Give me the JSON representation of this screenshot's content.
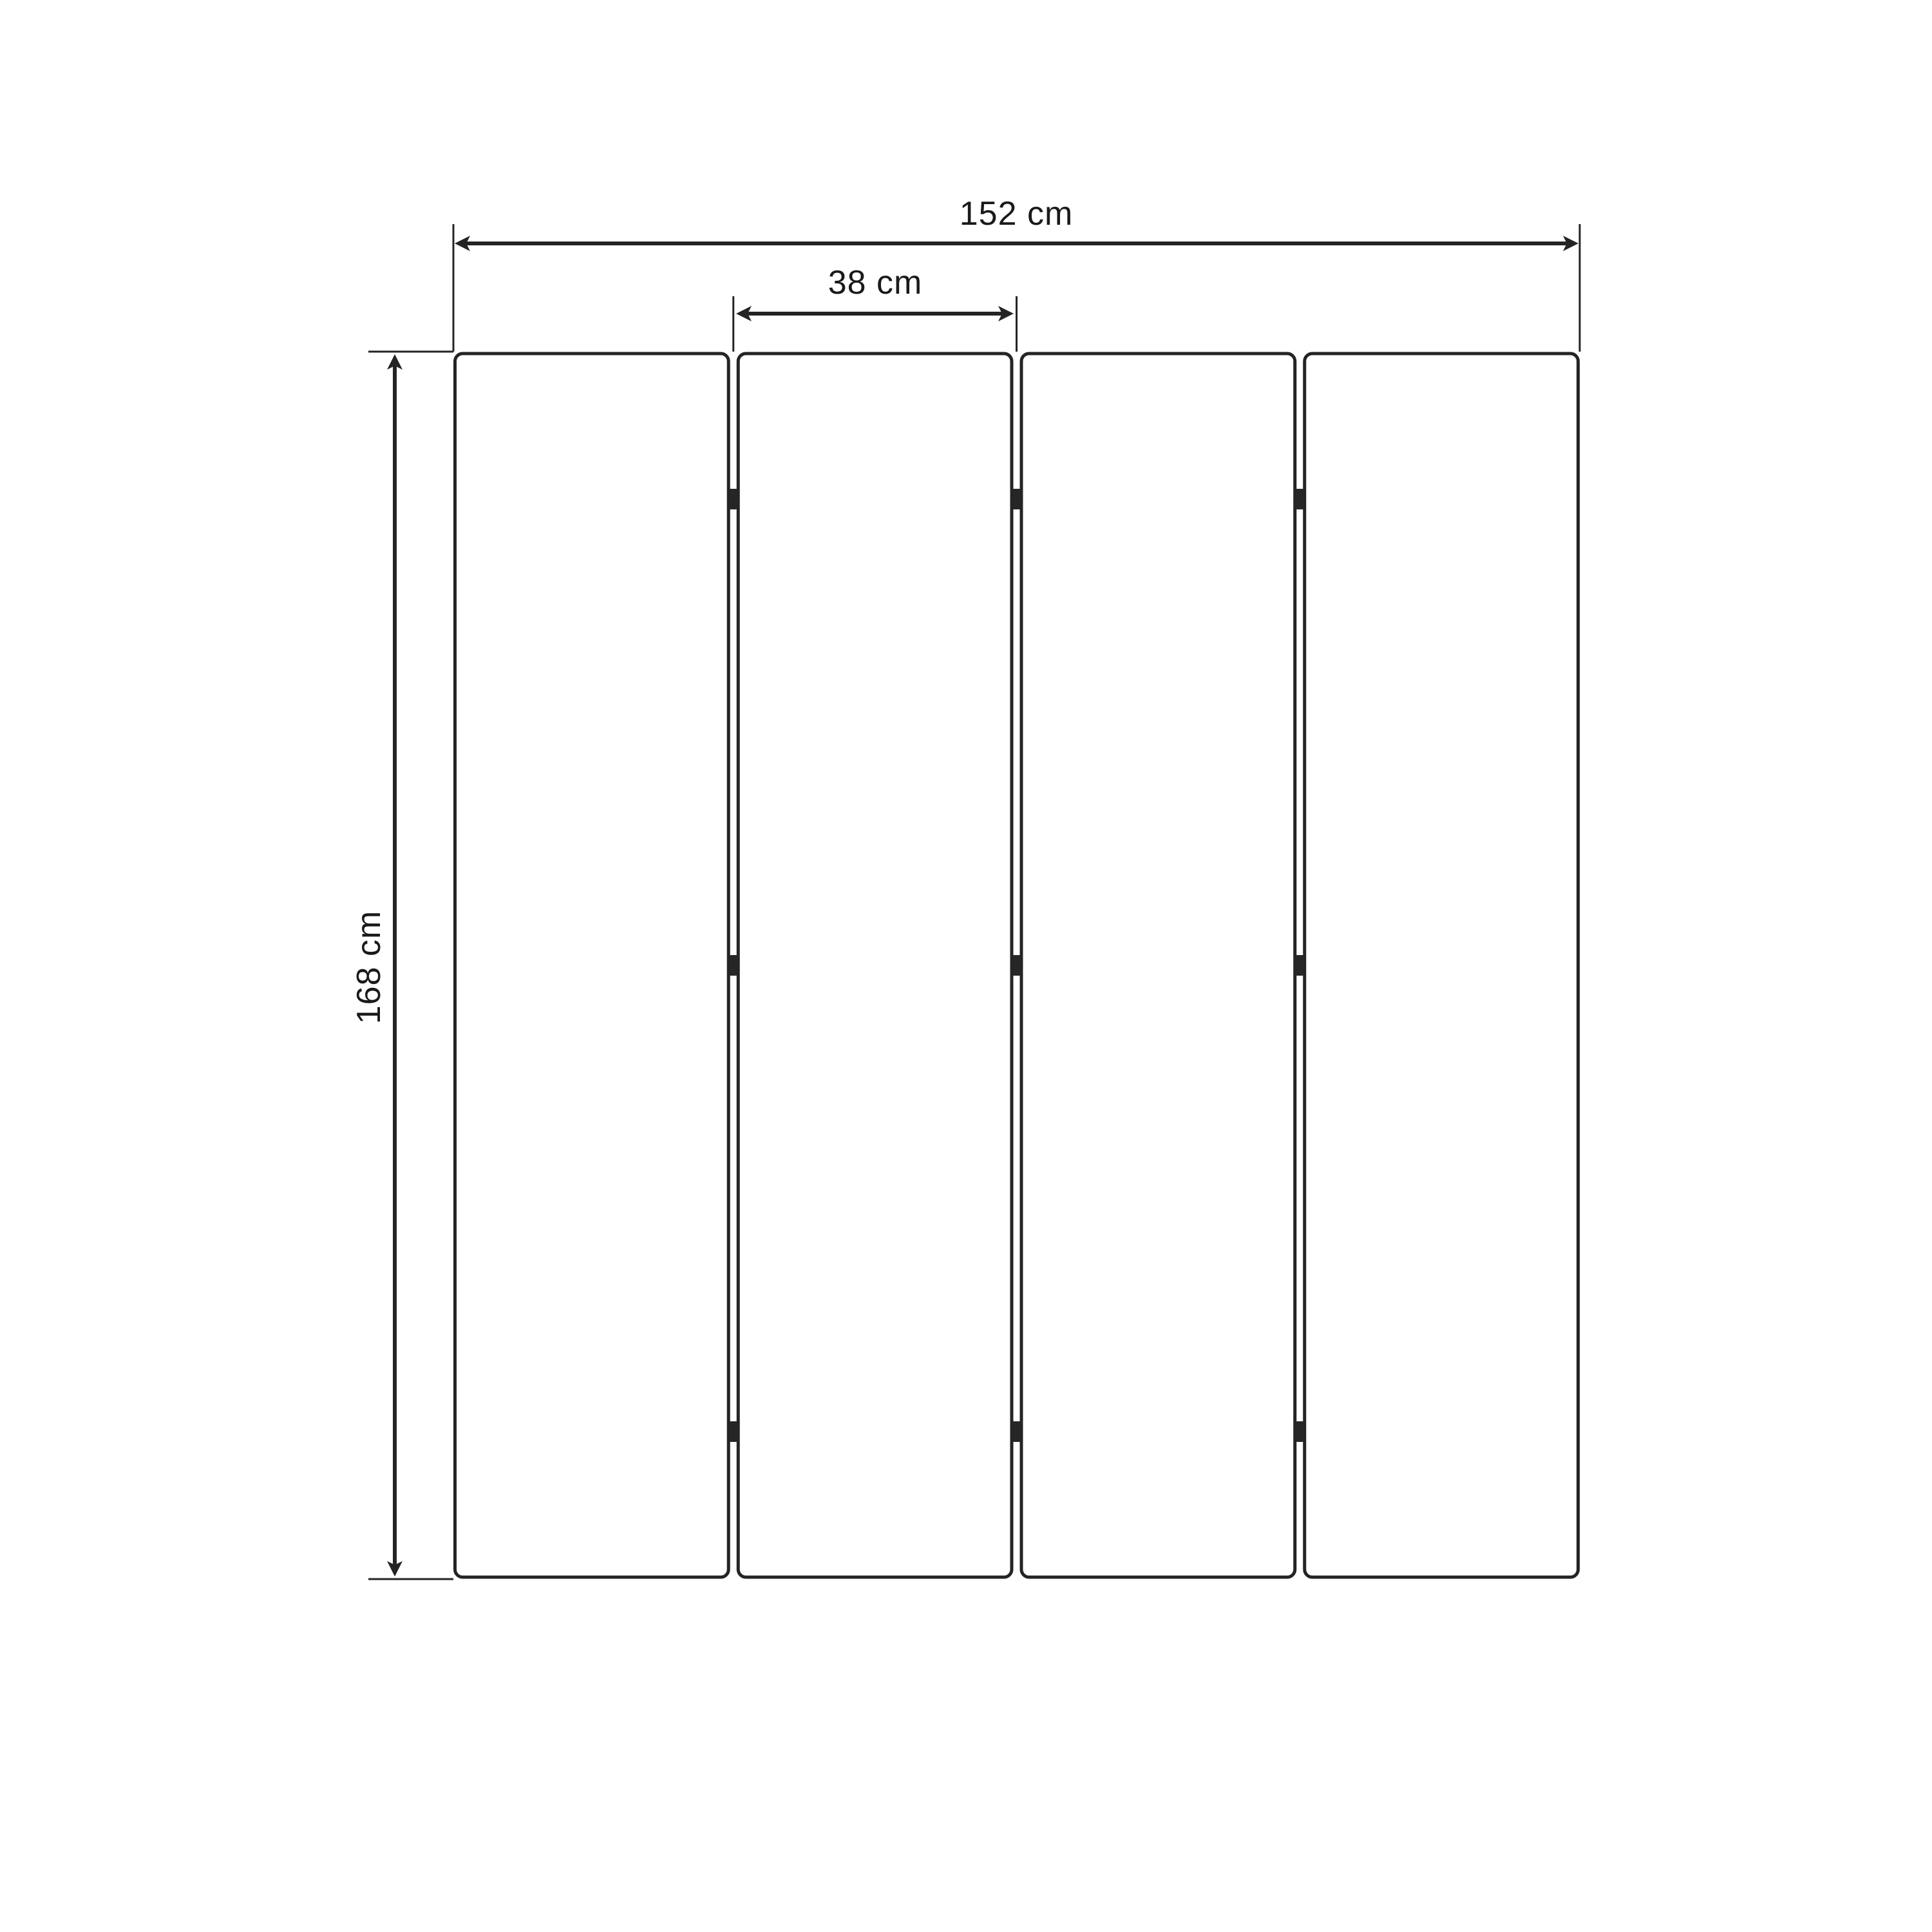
{
  "diagram": {
    "kind": "product-dimension-drawing",
    "panel_count": 4,
    "hinge_rows": 3,
    "dimensions": {
      "total_width_label": "152 cm",
      "total_width_value": 152,
      "panel_width_label": "38 cm",
      "panel_width_value": 38,
      "height_label": "168 cm",
      "height_value": 168,
      "unit": "cm"
    },
    "colors": {
      "line": "#242424",
      "panel_border": "#242424",
      "hinge": "#262626",
      "text": "#1a1a1a",
      "background": "#ffffff"
    }
  }
}
